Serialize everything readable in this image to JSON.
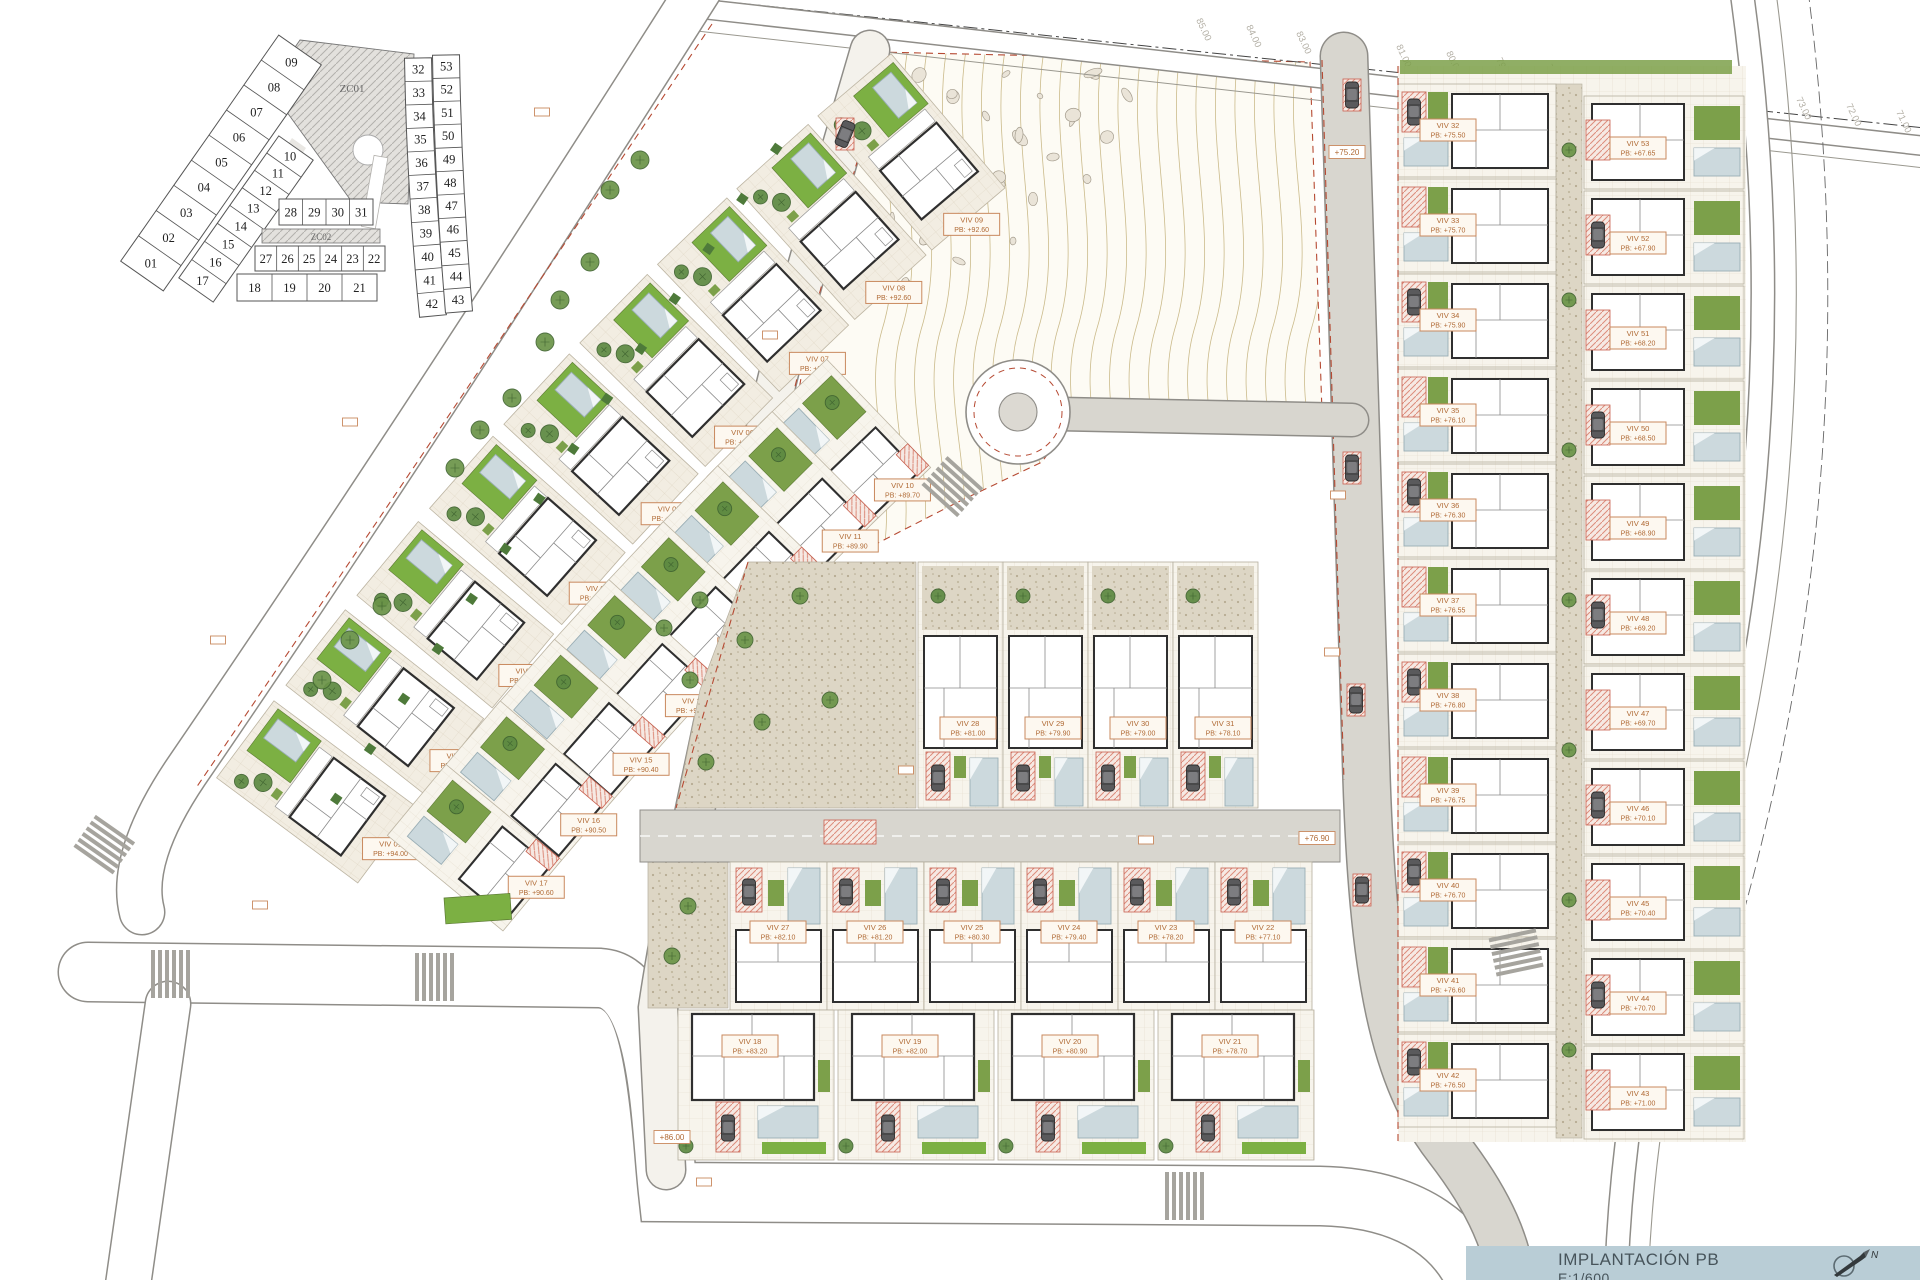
{
  "title_block": {
    "title": "IMPLANTACIÓN PB",
    "scale": "E:1/600"
  },
  "key_plan": {
    "zone_labels": {
      "zc01": "ZC01",
      "zc02": "ZC02"
    },
    "outer_lots": [
      "09",
      "08",
      "07",
      "06",
      "05",
      "04",
      "03",
      "02",
      "01"
    ],
    "inner_lots": [
      "10",
      "11",
      "12",
      "13",
      "14",
      "15",
      "16",
      "17"
    ],
    "center_rows": [
      [
        "28",
        "29",
        "30",
        "31"
      ],
      [
        "27",
        "26",
        "25",
        "24",
        "23",
        "22"
      ],
      [
        "18",
        "19",
        "20",
        "21"
      ]
    ],
    "right_west": [
      "32",
      "33",
      "34",
      "35",
      "36",
      "37",
      "38",
      "39",
      "40",
      "41",
      "42"
    ],
    "right_east": [
      "53",
      "52",
      "51",
      "50",
      "49",
      "48",
      "47",
      "46",
      "45",
      "44",
      "43"
    ]
  },
  "contour_labels": [
    "85.00",
    "84.00",
    "83.00",
    "82.00",
    "81.00",
    "80.00",
    "79.00",
    "78.00",
    "77.00",
    "76.00",
    "75.00",
    "74.00",
    "73.00",
    "72.00",
    "71.00"
  ],
  "road_markers": [
    "+75.20",
    "+76.90",
    "+86.00"
  ],
  "villas": {
    "left_outer": [
      {
        "id": "VIV 09",
        "pb": "PB: +92.60"
      },
      {
        "id": "VIV 08",
        "pb": "PB: +92.60"
      },
      {
        "id": "VIV 07",
        "pb": "PB: +92.80"
      },
      {
        "id": "VIV 06",
        "pb": "PB: +93.10"
      },
      {
        "id": "VIV 05",
        "pb": "PB: +93.40"
      },
      {
        "id": "VIV 04",
        "pb": "PB: +93.60"
      },
      {
        "id": "VIV 03",
        "pb": "PB: +93.80"
      },
      {
        "id": "VIV 02",
        "pb": "PB: +93.80"
      },
      {
        "id": "VIV 01",
        "pb": "PB: +94.00"
      }
    ],
    "left_inner": [
      {
        "id": "VIV 10",
        "pb": "PB: +89.70"
      },
      {
        "id": "VIV 11",
        "pb": "PB: +89.90"
      },
      {
        "id": "VIV 12",
        "pb": "PB: +90.10"
      },
      {
        "id": "VIV 13",
        "pb": "PB: +90.10"
      },
      {
        "id": "VIV 14",
        "pb": "PB: +90.20"
      },
      {
        "id": "VIV 15",
        "pb": "PB: +90.40"
      },
      {
        "id": "VIV 16",
        "pb": "PB: +90.50"
      },
      {
        "id": "VIV 17",
        "pb": "PB: +90.60"
      }
    ],
    "center_upper": [
      {
        "id": "VIV 28",
        "pb": "PB: +81.00"
      },
      {
        "id": "VIV 29",
        "pb": "PB: +79.90"
      },
      {
        "id": "VIV 30",
        "pb": "PB: +79.00"
      },
      {
        "id": "VIV 31",
        "pb": "PB: +78.10"
      }
    ],
    "center_middle": [
      {
        "id": "VIV 27",
        "pb": "PB: +82.10"
      },
      {
        "id": "VIV 26",
        "pb": "PB: +81.20"
      },
      {
        "id": "VIV 25",
        "pb": "PB: +80.30"
      },
      {
        "id": "VIV 24",
        "pb": "PB: +79.40"
      },
      {
        "id": "VIV 23",
        "pb": "PB: +78.20"
      },
      {
        "id": "VIV 22",
        "pb": "PB: +77.10"
      }
    ],
    "center_lower": [
      {
        "id": "VIV 18",
        "pb": "PB: +83.20"
      },
      {
        "id": "VIV 19",
        "pb": "PB: +82.00"
      },
      {
        "id": "VIV 20",
        "pb": "PB: +80.90"
      },
      {
        "id": "VIV 21",
        "pb": "PB: +78.70"
      }
    ],
    "right_west": [
      {
        "id": "VIV 32",
        "pb": "PB: +75.50"
      },
      {
        "id": "VIV 33",
        "pb": "PB: +75.70"
      },
      {
        "id": "VIV 34",
        "pb": "PB: +75.90"
      },
      {
        "id": "VIV 35",
        "pb": "PB: +76.10"
      },
      {
        "id": "VIV 36",
        "pb": "PB: +76.30"
      },
      {
        "id": "VIV 37",
        "pb": "PB: +76.55"
      },
      {
        "id": "VIV 38",
        "pb": "PB: +76.80"
      },
      {
        "id": "VIV 39",
        "pb": "PB: +76.75"
      },
      {
        "id": "VIV 40",
        "pb": "PB: +76.70"
      },
      {
        "id": "VIV 41",
        "pb": "PB: +76.60"
      },
      {
        "id": "VIV 42",
        "pb": "PB: +76.50"
      }
    ],
    "right_east": [
      {
        "id": "VIV 53",
        "pb": "PB: +67.65"
      },
      {
        "id": "VIV 52",
        "pb": "PB: +67.90"
      },
      {
        "id": "VIV 51",
        "pb": "PB: +68.20"
      },
      {
        "id": "VIV 50",
        "pb": "PB: +68.50"
      },
      {
        "id": "VIV 49",
        "pb": "PB: +68.90"
      },
      {
        "id": "VIV 48",
        "pb": "PB: +69.20"
      },
      {
        "id": "VIV 47",
        "pb": "PB: +69.70"
      },
      {
        "id": "VIV 46",
        "pb": "PB: +70.10"
      },
      {
        "id": "VIV 45",
        "pb": "PB: +70.40"
      },
      {
        "id": "VIV 44",
        "pb": "PB: +70.70"
      },
      {
        "id": "VIV 43",
        "pb": "PB: +71.00"
      }
    ]
  },
  "colors": {
    "label_text": "#b06a35",
    "label_border": "#c9895e",
    "label_bg": "#fdf8f0",
    "lawn": "#7cb043",
    "garden": "#7ca04a",
    "tree": "#5d8a42",
    "pool": "#ccd9dd",
    "wall": "#2f2f2f",
    "road_casing": "#8f8d88",
    "asphalt": "#d8d6cf",
    "gravel": "#ddd6c5",
    "paving": "#f2ede2",
    "red_dash": "#b64a33",
    "contour": "#c5b480",
    "title_bg": "#b9cdd6"
  }
}
